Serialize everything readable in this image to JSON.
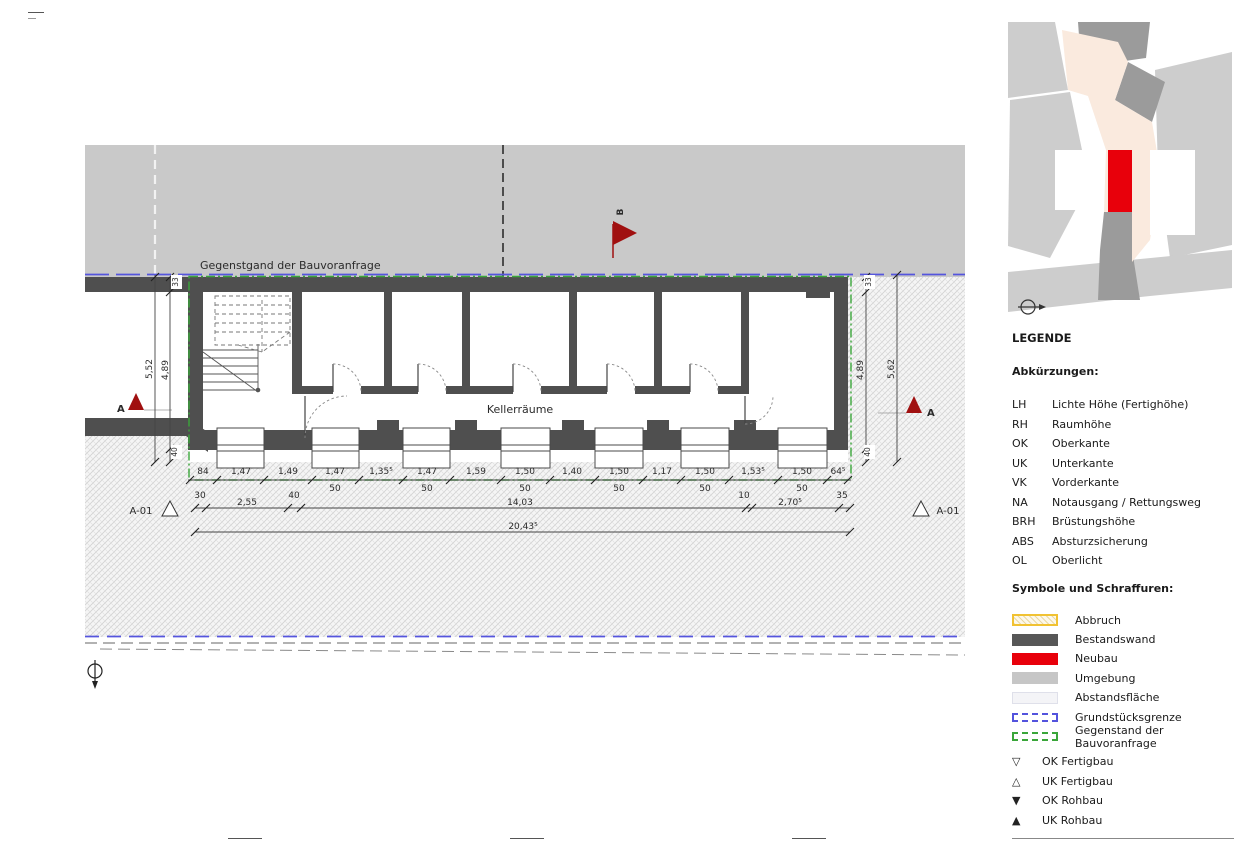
{
  "plan": {
    "boundary_label": "Gegenstgand der Bauvoranfrage",
    "room_label": "Kellerräume",
    "section_a": "A",
    "section_b": "B",
    "detail_ref_left": "A-01",
    "detail_ref_right": "A-01",
    "dims_row1": [
      "84",
      "1,47",
      "1,49",
      "1,47",
      "1,35⁵",
      "1,47",
      "1,59",
      "1,50",
      "1,40",
      "1,50",
      "1,17",
      "1,50",
      "1,53⁵",
      "1,50",
      "64⁵"
    ],
    "dims_row1_sub": [
      "50",
      "50",
      "50",
      "50",
      "50",
      "50"
    ],
    "dims_row2": [
      "30",
      "2,55",
      "40",
      "14,03",
      "10",
      "2,70⁵",
      "35"
    ],
    "dims_total": "20,43⁵",
    "dims_left": {
      "wall": "33",
      "inner": "4,89",
      "outer": "5,52",
      "bottom": "40"
    },
    "dims_right": {
      "wall": "33",
      "inner": "4,89",
      "outer": "5,62",
      "bottom": "40"
    }
  },
  "legend": {
    "title": "LEGENDE",
    "abbr_heading": "Abkürzungen:",
    "abbreviations": [
      {
        "abbr": "LH",
        "term": "Lichte Höhe (Fertighöhe)"
      },
      {
        "abbr": "RH",
        "term": "Raumhöhe"
      },
      {
        "abbr": "OK",
        "term": "Oberkante"
      },
      {
        "abbr": "UK",
        "term": "Unterkante"
      },
      {
        "abbr": "VK",
        "term": "Vorderkante"
      },
      {
        "abbr": "NA",
        "term": "Notausgang / Rettungsweg"
      },
      {
        "abbr": "BRH",
        "term": "Brüstungshöhe"
      },
      {
        "abbr": "ABS",
        "term": "Absturzsicherung"
      },
      {
        "abbr": "OL",
        "term": "Oberlicht"
      }
    ],
    "symbols_heading": "Symbole und Schraffuren:",
    "hatches": [
      {
        "label": "Abbruch"
      },
      {
        "label": "Bestandswand"
      },
      {
        "label": "Neubau"
      },
      {
        "label": "Umgebung"
      },
      {
        "label": "Abstandsfläche"
      },
      {
        "label": "Grundstücksgrenze"
      },
      {
        "label": "Gegenstand der Bauvoranfrage"
      }
    ],
    "markers": [
      {
        "glyph": "▽",
        "label": "OK Fertigbau"
      },
      {
        "glyph": "△",
        "label": "UK Fertigbau"
      },
      {
        "glyph": "▼",
        "label": "OK Rohbau"
      },
      {
        "glyph": "▲",
        "label": "UK Rohbau"
      }
    ]
  },
  "colors": {
    "neubau_red": "#e8000b",
    "bestandswand_gray": "#4f4f4f",
    "umgebung_gray": "#c9c9c9",
    "grundstuecksgrenze_blue": "#5555dd",
    "bauvoranfrage_green": "#3aa63a",
    "section_marker_red": "#a01010"
  }
}
